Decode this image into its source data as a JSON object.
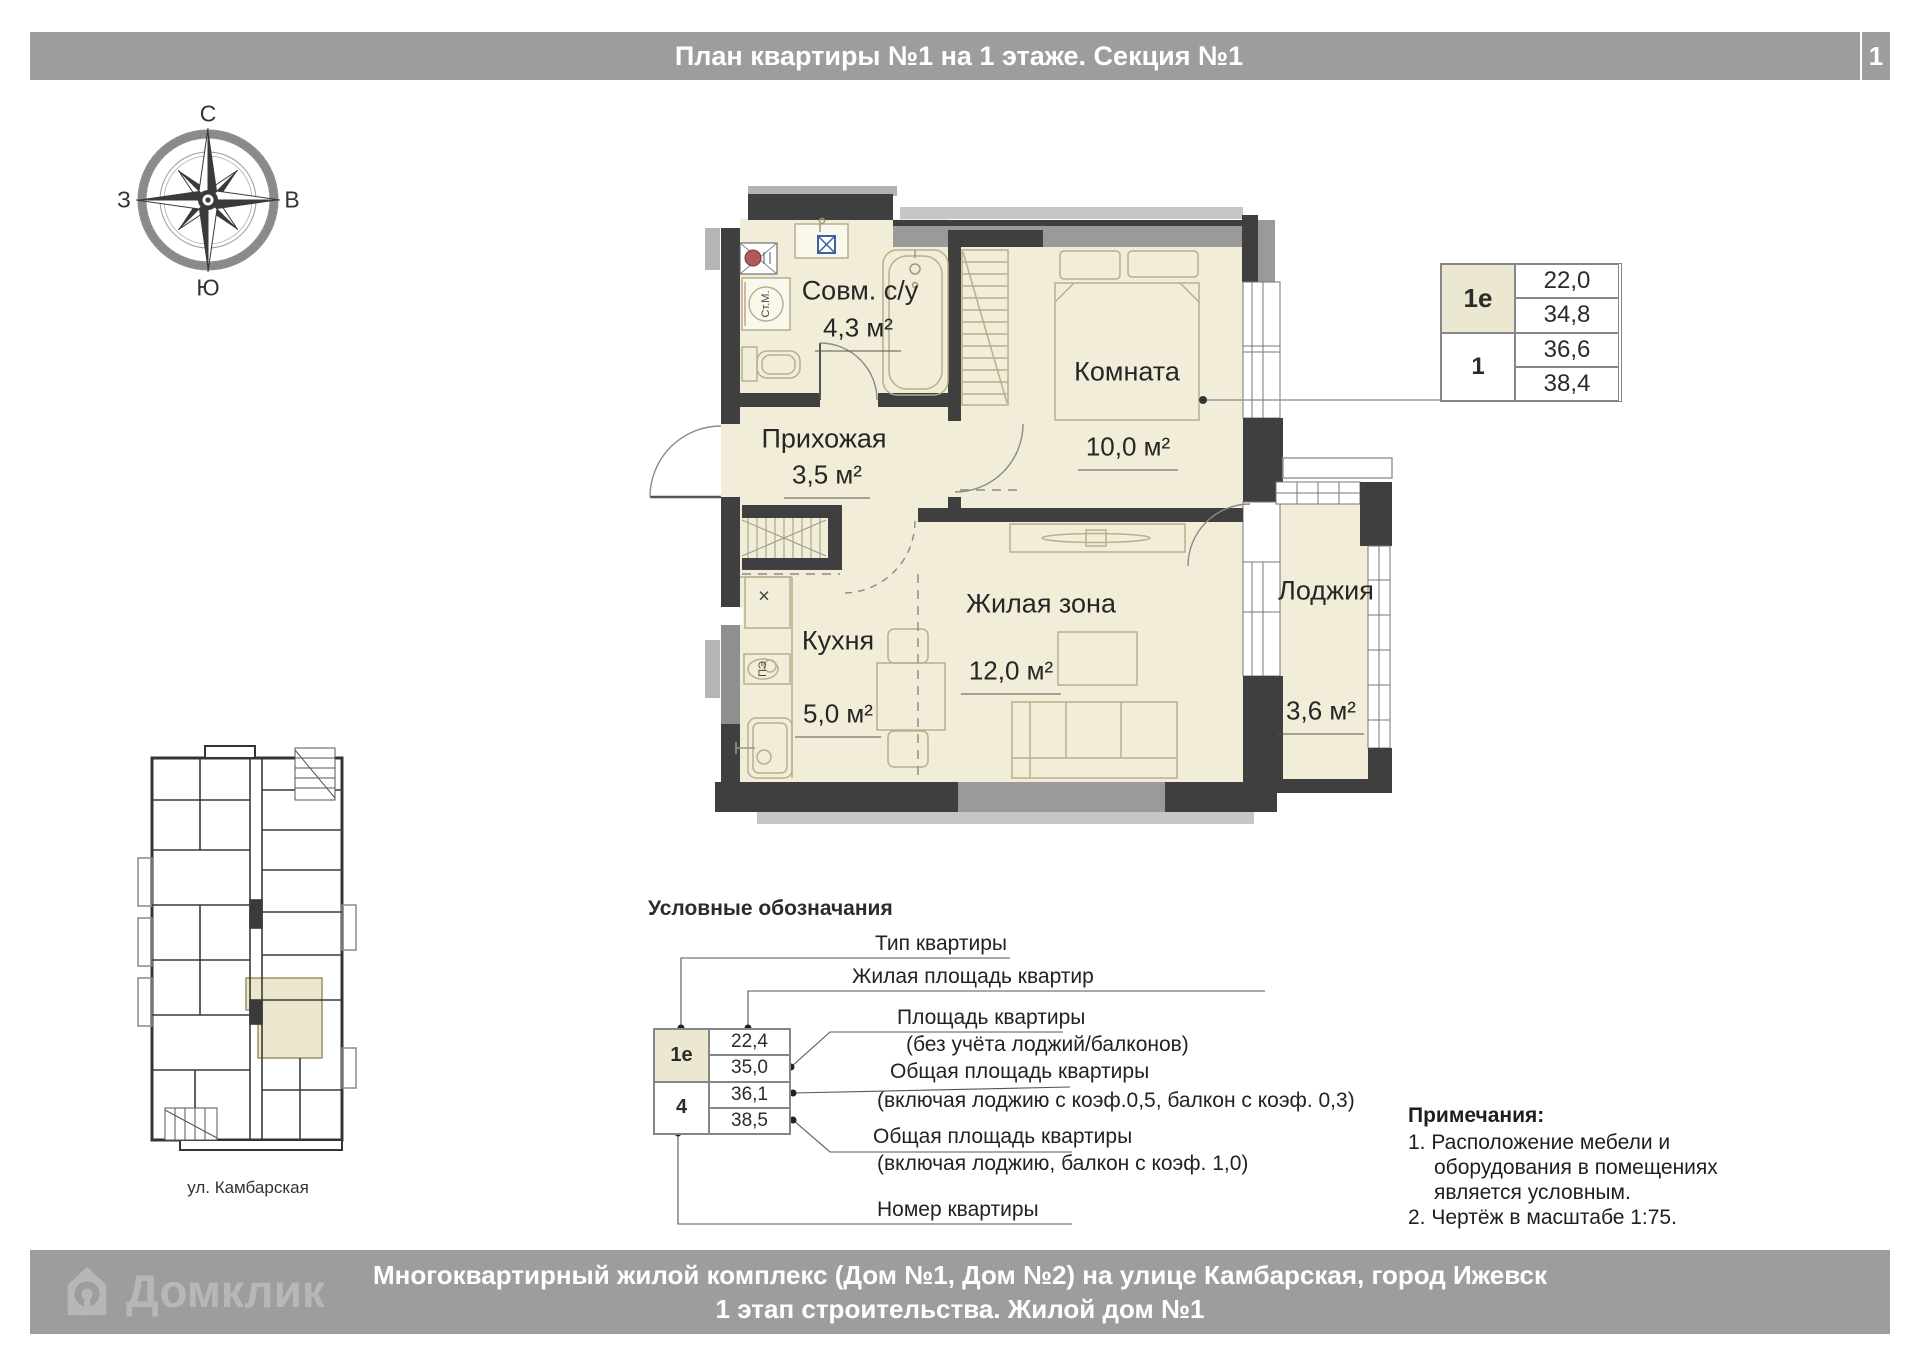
{
  "header": {
    "title": "План квартиры №1 на 1 этаже. Секция №1",
    "page": "1"
  },
  "compass": {
    "n": "С",
    "s": "Ю",
    "w": "З",
    "e": "В"
  },
  "plan": {
    "rooms": [
      {
        "name": "Совм. с/у",
        "area": "4,3 м²"
      },
      {
        "name": "Прихожая",
        "area": "3,5 м²"
      },
      {
        "name": "Комната",
        "area": "10,0 м²"
      },
      {
        "name": "Кухня",
        "area": "5,0 м²"
      },
      {
        "name": "Жилая зона",
        "area": "12,0 м²"
      },
      {
        "name": "Лоджия",
        "area": "3,6 м²"
      }
    ],
    "fixture_labels": {
      "washer": "Ст.М.",
      "stove": "ПЭ",
      "vent": "×"
    }
  },
  "info_table": {
    "type": "1е",
    "flat_number": "1",
    "values": [
      "22,0",
      "34,8",
      "36,6",
      "38,4"
    ]
  },
  "key_plan": {
    "street": "ул. Камбарская"
  },
  "legend": {
    "title": "Условные обозначания",
    "sample": {
      "type": "1е",
      "flat_number": "4",
      "values": [
        "22,4",
        "35,0",
        "36,1",
        "38,5"
      ]
    },
    "labels": {
      "type": "Тип квартиры",
      "living_area": "Жилая площадь квартир",
      "flat_area": "Площадь квартиры",
      "flat_area_sub": "(без учёта лоджий/балконов)",
      "total_area1": "Общая площадь квартиры",
      "total_area1_sub": "(включая лоджию с коэф.0,5, балкон с коэф. 0,3)",
      "total_area2": "Общая площадь квартиры",
      "total_area2_sub": "(включая лоджию, балкон с коэф. 1,0)",
      "flat_number": "Номер квартиры"
    }
  },
  "notes": {
    "title": "Примечания:",
    "items": [
      "1. Расположение мебели и оборудования в помещениях является условным.",
      "2. Чертёж в масштабе 1:75."
    ]
  },
  "footer": {
    "brand": "Домклик",
    "line1": "Многоквартирный жилой комплекс (Дом №1, Дом №2) на улице Камбарская, город Ижевск",
    "line2": "1 этап строительства. Жилой дом №1"
  },
  "colors": {
    "wall": "#3f3f3f",
    "floor": "#f1edd8",
    "accent_beige": "#ece7d0",
    "bar_gray": "#9d9d9d",
    "riser_red": "#b25858",
    "sink_blue": "#3a5f9e"
  }
}
